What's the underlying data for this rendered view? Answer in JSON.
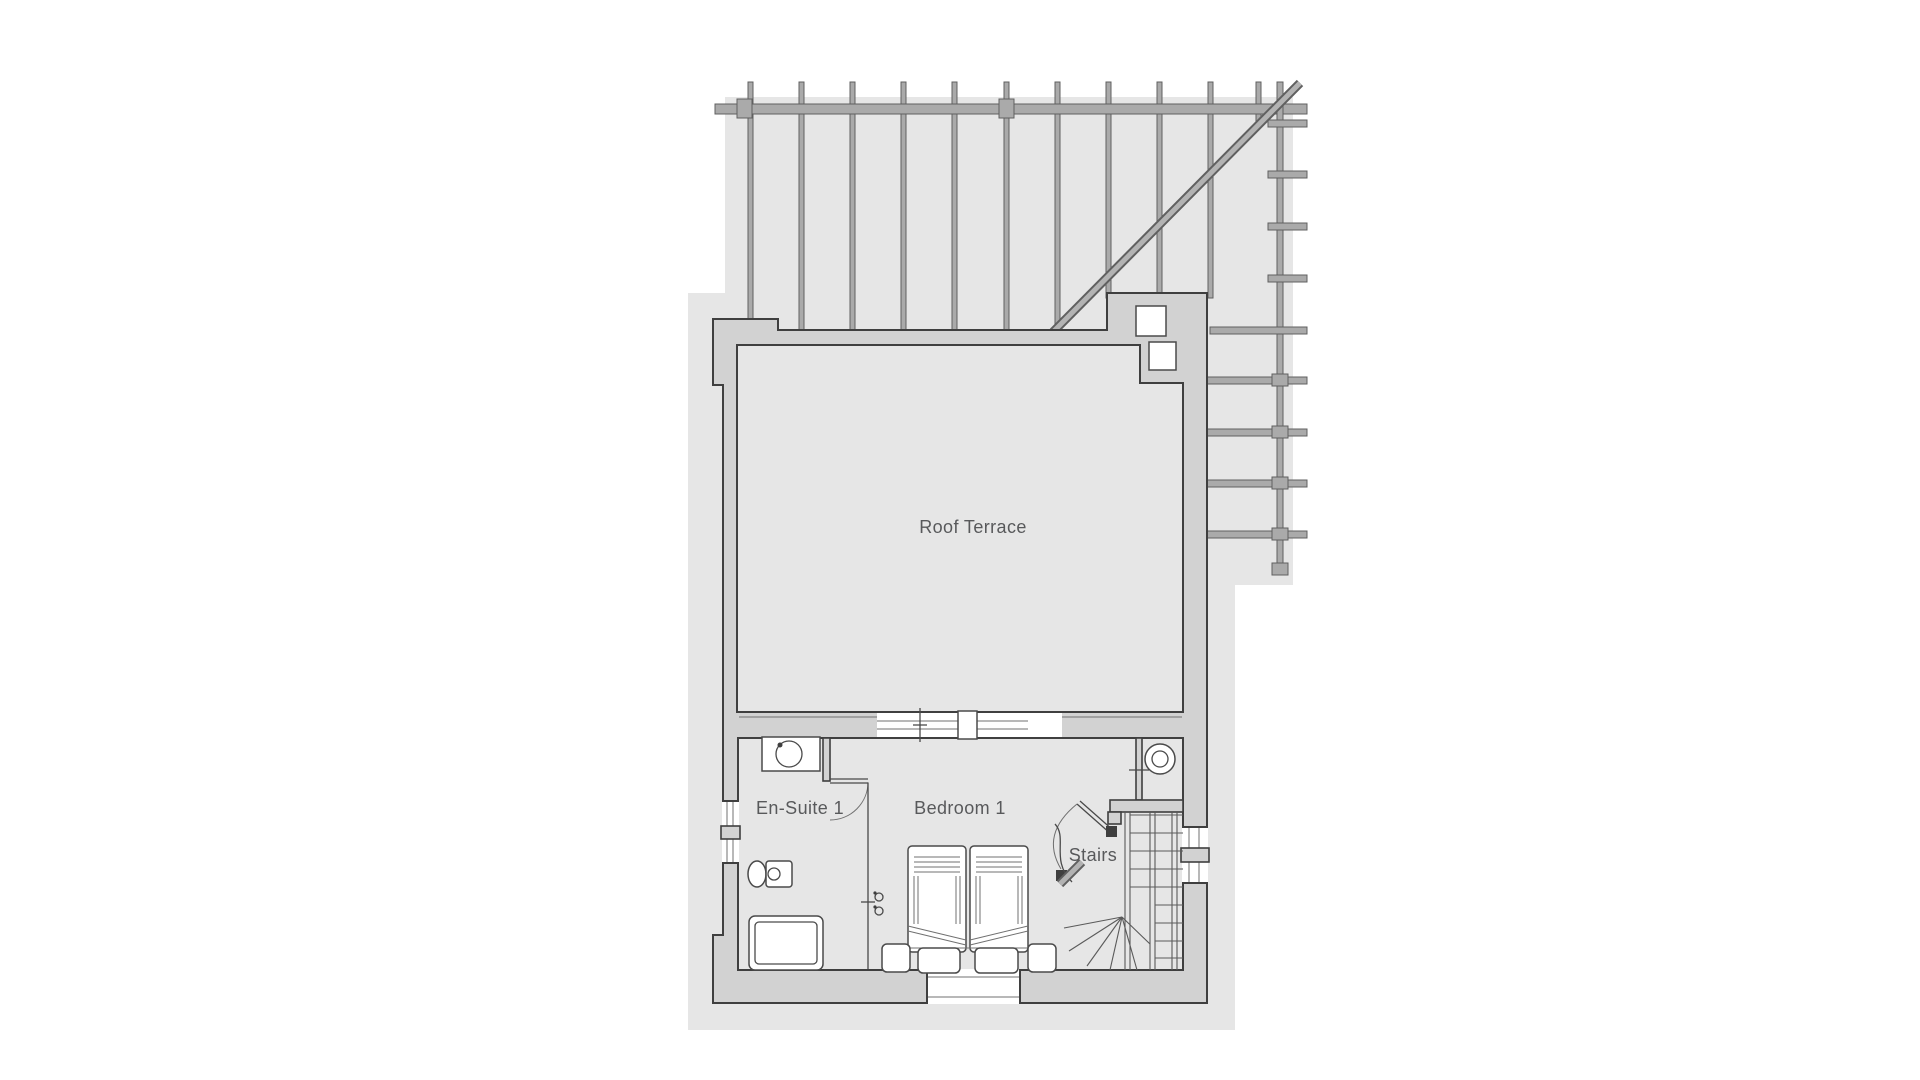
{
  "plan": {
    "rooms": {
      "roof_terrace": {
        "label": "Roof Terrace"
      },
      "en_suite": {
        "label": "En-Suite 1"
      },
      "bedroom": {
        "label": "Bedroom 1"
      },
      "stairs": {
        "label": "Stairs"
      }
    },
    "structure": {
      "pergola_posts": 11,
      "pergola_side_rails": 9,
      "fixture_icons": [
        "vanity-basin-icon",
        "toilet-icon",
        "bath-icon",
        "bed-icon",
        "ottoman-icon",
        "nightstand-icon",
        "winder-stair-icon",
        "column-icon",
        "door-swing-icon"
      ]
    },
    "colors": {
      "backdrop": "#e6e6e6",
      "wall_fill": "#d2d2d2",
      "wall_outline": "#3f3f3f",
      "pergola_bar": "#aaaaaa",
      "pergola_edge": "#606060",
      "fixture_line": "#4a4a4a",
      "label_text": "#58595b"
    }
  }
}
